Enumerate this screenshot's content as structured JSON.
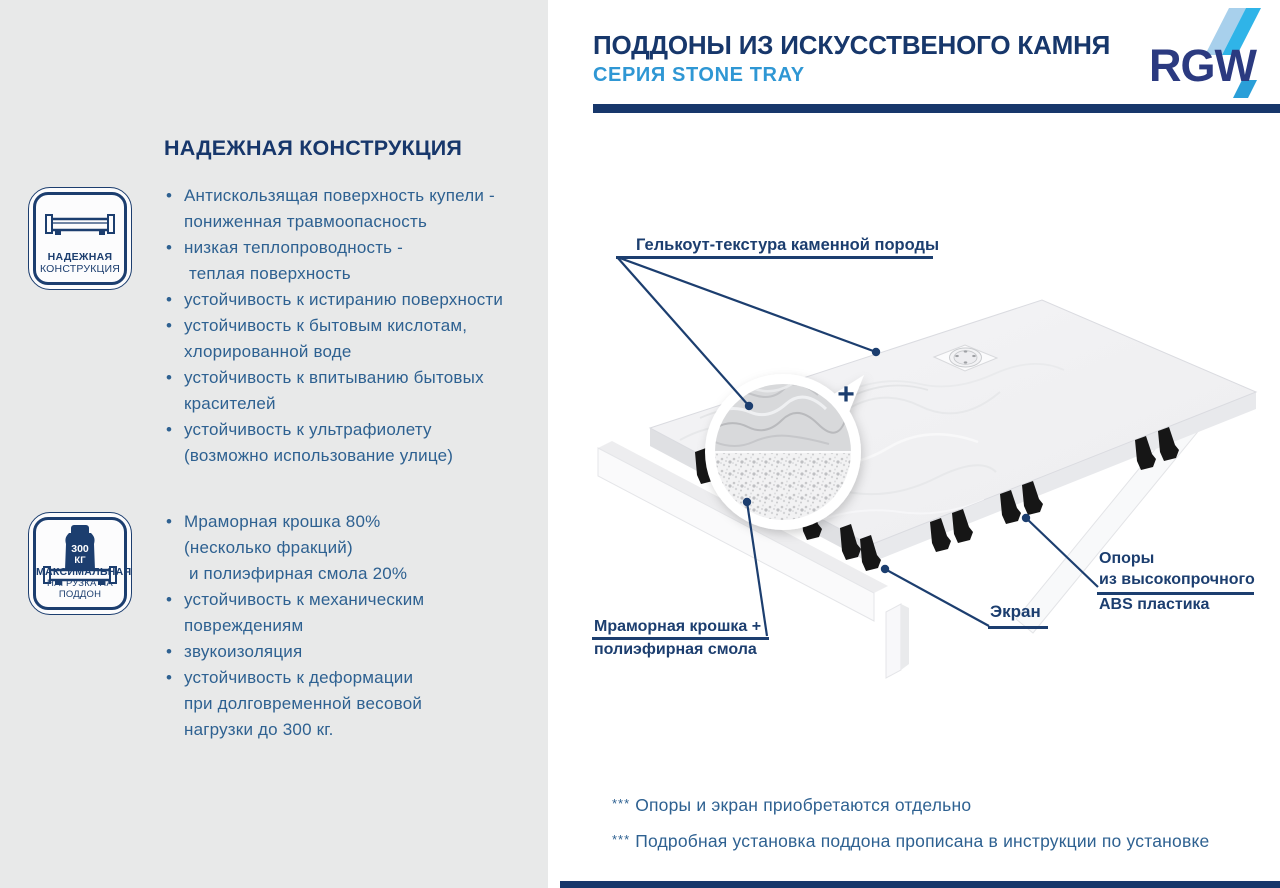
{
  "palette": {
    "navy": "#17376b",
    "label-navy": "#1c3e6f",
    "blue": "#2f97d4",
    "text-blue": "#2e6191",
    "panel": "#e8e9e9",
    "logo-navy": "#2b3a80",
    "logo-light": "#a8d0ec",
    "logo-cyan": "#2fb4e8",
    "logo-mid": "#2a9fd8"
  },
  "header": {
    "title": "ПОДДОНЫ ИЗ ИСКУССТВЕНОГО КАМНЯ",
    "subtitle": "СЕРИЯ STONE TRAY",
    "logo_text": "RGW"
  },
  "left_panel": {
    "heading": "НАДЕЖНАЯ КОНСТРУКЦИЯ",
    "badge_construction": {
      "icon": "tray-cross-section-icon",
      "line1": "НАДЕЖНАЯ",
      "line2": "КОНСТРУКЦИЯ"
    },
    "badge_load": {
      "icon": "weight-on-tray-icon",
      "weight_value": "300",
      "weight_unit": "КГ",
      "line1": "МАКСИМАЛЬНАЯ",
      "line2": "НАГРУЗКА НА ПОДДОН"
    },
    "features_group1": [
      [
        "Антискользящая поверхность купели -",
        "пониженная травмоопасность"
      ],
      [
        "низкая теплопроводность -",
        " теплая поверхность"
      ],
      [
        "устойчивость к истиранию поверхности"
      ],
      [
        "устойчивость к бытовым кислотам,",
        "хлорированной воде"
      ],
      [
        "устойчивость к впитыванию бытовых",
        "красителей"
      ],
      [
        "устойчивость к ультрафиолету",
        "(возможно использование улице)"
      ]
    ],
    "features_group2": [
      [
        "Мраморная крошка 80%",
        "(несколько фракций)",
        " и полиэфирная смола 20%"
      ],
      [
        "устойчивость к механическим",
        "повреждениям"
      ],
      [
        "звукоизоляция"
      ],
      [
        "устойчивость к деформации",
        "при долговременной весовой",
        "нагрузки до 300 кг."
      ]
    ]
  },
  "diagram": {
    "label_gelcoat": "Гелькоут-текстура каменной породы",
    "label_marble_line1": "Мраморная крошка +",
    "label_marble_line2": "полиэфирная смола",
    "label_screen": "Экран",
    "label_supports_line1": "Опоры",
    "label_supports_line2": "из высокопрочного",
    "label_supports_line3": "ABS пластика",
    "plus_sign": "+"
  },
  "footnotes": [
    {
      "marker": "***",
      "text": "Опоры и экран приобретаются отдельно"
    },
    {
      "marker": "***",
      "text": "Подробная установка поддона прописана в инструкции по установке"
    }
  ]
}
